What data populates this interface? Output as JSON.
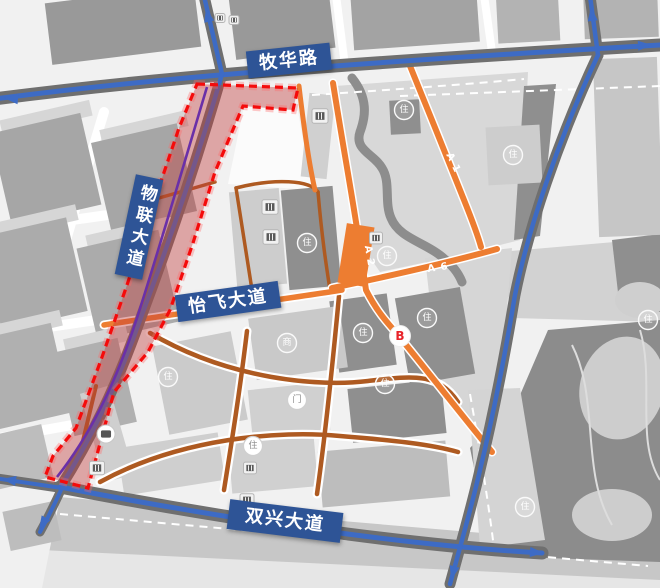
{
  "map": {
    "banners": [
      {
        "id": "muhua",
        "label": "牧华路",
        "x": 247,
        "y": 47,
        "w": 84,
        "h": 27,
        "rotate": -6,
        "vertical": false
      },
      {
        "id": "wulian",
        "label": "物联大道",
        "x": 125,
        "y": 176,
        "w": 28,
        "h": 102,
        "rotate": 12,
        "vertical": true
      },
      {
        "id": "yifei",
        "label": "怡飞大道",
        "x": 176,
        "y": 288,
        "w": 104,
        "h": 27,
        "rotate": -8,
        "vertical": false
      },
      {
        "id": "shuangxing",
        "label": "双兴大道",
        "x": 228,
        "y": 506,
        "w": 114,
        "h": 30,
        "rotate": 7,
        "vertical": false
      }
    ],
    "road_labels": [
      {
        "id": "a1",
        "label": "A 1",
        "x": 453,
        "y": 163,
        "rotate": 64
      },
      {
        "id": "a2",
        "label": "A 2",
        "x": 369,
        "y": 256,
        "rotate": 80
      },
      {
        "id": "a6",
        "label": "A 6",
        "x": 438,
        "y": 268,
        "rotate": -8
      }
    ],
    "point_label": {
      "label": "B",
      "x": 400,
      "y": 336
    },
    "circle_markers": [
      {
        "x": 307,
        "y": 243,
        "glyph": "住",
        "variant": "outline"
      },
      {
        "x": 387,
        "y": 256,
        "glyph": "住",
        "variant": "outline"
      },
      {
        "x": 404,
        "y": 110,
        "glyph": "住",
        "variant": "outline"
      },
      {
        "x": 513,
        "y": 155,
        "glyph": "住",
        "variant": "outline"
      },
      {
        "x": 427,
        "y": 318,
        "glyph": "住",
        "variant": "outline"
      },
      {
        "x": 363,
        "y": 333,
        "glyph": "住",
        "variant": "outline"
      },
      {
        "x": 385,
        "y": 384,
        "glyph": "住",
        "variant": "outline"
      },
      {
        "x": 287,
        "y": 343,
        "glyph": "商",
        "variant": "outline"
      },
      {
        "x": 168,
        "y": 377,
        "glyph": "住",
        "variant": "outline"
      },
      {
        "x": 297,
        "y": 400,
        "glyph": "门",
        "variant": "solid"
      },
      {
        "x": 253,
        "y": 446,
        "glyph": "住",
        "variant": "solid"
      },
      {
        "x": 525,
        "y": 507,
        "glyph": "住",
        "variant": "outline"
      },
      {
        "x": 648,
        "y": 320,
        "glyph": "住",
        "variant": "outline"
      }
    ],
    "poi_markers": [
      {
        "x": 220,
        "y": 18,
        "shape": "square",
        "icon": "building-icon",
        "size": 10
      },
      {
        "x": 234,
        "y": 20,
        "shape": "square",
        "icon": "building-icon",
        "size": 10
      },
      {
        "x": 320,
        "y": 116,
        "shape": "square",
        "icon": "transit-icon",
        "size": 16
      },
      {
        "x": 270,
        "y": 207,
        "shape": "square",
        "icon": "facility-icon",
        "size": 16
      },
      {
        "x": 271,
        "y": 237,
        "shape": "square",
        "icon": "facility-icon",
        "size": 16
      },
      {
        "x": 376,
        "y": 238,
        "shape": "square",
        "icon": "facility-icon",
        "size": 13
      },
      {
        "x": 106,
        "y": 434,
        "shape": "circle",
        "icon": "bus-icon",
        "size": 18
      },
      {
        "x": 97,
        "y": 468,
        "shape": "square",
        "icon": "metro-icon",
        "size": 15
      },
      {
        "x": 247,
        "y": 500,
        "shape": "square",
        "icon": "facility-icon",
        "size": 14
      },
      {
        "x": 250,
        "y": 468,
        "shape": "square",
        "icon": "facility-icon",
        "size": 13
      }
    ],
    "colors": {
      "banner_bg": "#2E5496",
      "banner_text": "#FFFFFF",
      "major_road_blue": "#3D6BC5",
      "secondary_road_orange": "#ED7D31",
      "local_road_brown": "#AE5A21",
      "corridor_fill": "#C23B3B",
      "corridor_border": "#F40B0B",
      "metro_line_purple": "#6A30A8",
      "point_b_text": "#E8232A"
    }
  }
}
